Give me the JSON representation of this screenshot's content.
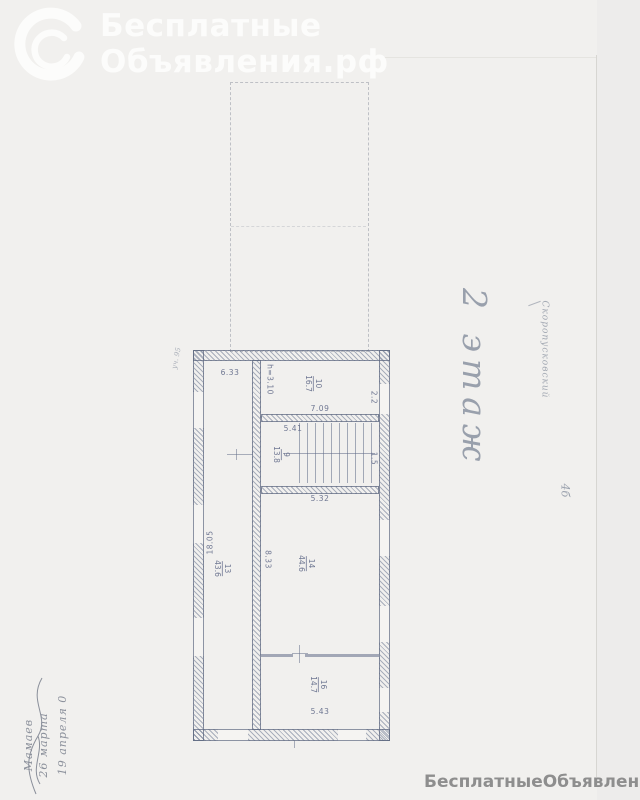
{
  "watermark_top": {
    "brand_line1": "Бесплатные",
    "brand_line2": "Объявления.рф",
    "color": "#fcfcfb"
  },
  "watermark_bottom": {
    "text": "БесплатныеОбъявления.рф",
    "color": "#8e8e8e"
  },
  "handwriting": {
    "floor_label": "2 этаж",
    "street_note": "Скоропусковский",
    "house_note": "4б",
    "corner_note": "уч. 95",
    "margin_note_lines": [
      "19 апреля 0",
      "26 марта",
      "Мамаев"
    ]
  },
  "plan": {
    "ink_color": "#6f7792",
    "dims": {
      "top_left_room_width": "6.33",
      "ceiling_height": "h=3.10",
      "right_top": "2.2",
      "room10_width": "7.09",
      "stair_width_top": "5.41",
      "right_mid": "1.5",
      "stair_width_bottom": "5.32",
      "left_height": "18.05",
      "mid_height": "8.33",
      "bottom_room_width": "5.43"
    },
    "rooms": [
      {
        "number": "10",
        "area": "16.7"
      },
      {
        "number": "9",
        "area": "13.8"
      },
      {
        "number": "13",
        "area": "43.6"
      },
      {
        "number": "14",
        "area": "44.6"
      },
      {
        "number": "16",
        "area": "14.7"
      }
    ]
  }
}
